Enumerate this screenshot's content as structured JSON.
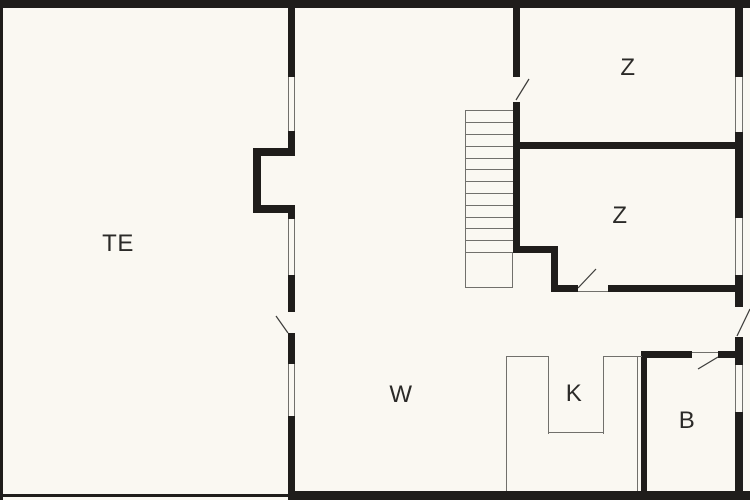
{
  "canvas": {
    "width": 750,
    "height": 500,
    "background": "#faf8f2",
    "wall_color": "#1f1d1b",
    "line_color": "#71706c",
    "swing_color": "#3a3a38",
    "label_color": "#2b2a28",
    "label_font_size": 24
  },
  "rooms": [
    {
      "id": "terrace",
      "label": "TE",
      "cx": 118,
      "cy": 244
    },
    {
      "id": "living-hall",
      "label": "W",
      "cx": 401,
      "cy": 395
    },
    {
      "id": "kitchen",
      "label": "K",
      "cx": 574,
      "cy": 394
    },
    {
      "id": "bathroom",
      "label": "B",
      "cx": 687,
      "cy": 421
    },
    {
      "id": "bedroom-top",
      "label": "Z",
      "cx": 628,
      "cy": 68
    },
    {
      "id": "bedroom-bottom",
      "label": "Z",
      "cx": 620,
      "cy": 216
    }
  ],
  "walls": [
    {
      "name": "wall-exterior-top",
      "x": 0,
      "y": 0,
      "w": 750,
      "h": 8
    },
    {
      "name": "wall-terrace-left-thin",
      "x": 0,
      "y": 0,
      "w": 3,
      "h": 500
    },
    {
      "name": "wall-terrace-bottom-thin",
      "x": 0,
      "y": 494,
      "w": 288,
      "h": 3
    },
    {
      "name": "wall-exterior-bottom",
      "x": 288,
      "y": 491,
      "w": 462,
      "h": 9
    },
    {
      "name": "wall-exterior-right-1",
      "x": 735,
      "y": 0,
      "w": 8,
      "h": 77
    },
    {
      "name": "wall-exterior-right-2",
      "x": 735,
      "y": 132,
      "w": 8,
      "h": 86
    },
    {
      "name": "wall-exterior-right-3",
      "x": 735,
      "y": 275,
      "w": 8,
      "h": 32
    },
    {
      "name": "wall-exterior-right-4",
      "x": 735,
      "y": 337,
      "w": 8,
      "h": 28
    },
    {
      "name": "wall-exterior-right-5",
      "x": 735,
      "y": 412,
      "w": 8,
      "h": 88
    },
    {
      "name": "wall-terrace-east-1",
      "x": 288,
      "y": 0,
      "w": 7,
      "h": 77
    },
    {
      "name": "wall-terrace-east-2",
      "x": 288,
      "y": 131,
      "w": 7,
      "h": 17
    },
    {
      "name": "wall-niche-top",
      "x": 253,
      "y": 148,
      "w": 42,
      "h": 8
    },
    {
      "name": "wall-niche-left",
      "x": 253,
      "y": 148,
      "w": 8,
      "h": 65
    },
    {
      "name": "wall-niche-bottom",
      "x": 253,
      "y": 205,
      "w": 42,
      "h": 8
    },
    {
      "name": "wall-terrace-east-3",
      "x": 288,
      "y": 213,
      "w": 7,
      "h": 6
    },
    {
      "name": "wall-terrace-east-4",
      "x": 288,
      "y": 275,
      "w": 7,
      "h": 37
    },
    {
      "name": "wall-terrace-east-5",
      "x": 288,
      "y": 333,
      "w": 7,
      "h": 31
    },
    {
      "name": "wall-terrace-east-6",
      "x": 288,
      "y": 416,
      "w": 7,
      "h": 84
    },
    {
      "name": "wall-stairhall-east-1",
      "x": 513,
      "y": 0,
      "w": 7,
      "h": 77
    },
    {
      "name": "wall-stairhall-east-2",
      "x": 513,
      "y": 102,
      "w": 7,
      "h": 151
    },
    {
      "name": "wall-stair-jog-horizontal",
      "x": 513,
      "y": 246,
      "w": 45,
      "h": 7
    },
    {
      "name": "wall-stair-jog-vertical",
      "x": 551,
      "y": 246,
      "w": 7,
      "h": 46
    },
    {
      "name": "wall-bedroom-divider",
      "x": 513,
      "y": 142,
      "w": 230,
      "h": 7
    },
    {
      "name": "wall-bedroom-bottom-south-1",
      "x": 551,
      "y": 285,
      "w": 27,
      "h": 7
    },
    {
      "name": "wall-bedroom-bottom-south-2",
      "x": 608,
      "y": 285,
      "w": 135,
      "h": 7
    },
    {
      "name": "wall-bathroom-top-1",
      "x": 641,
      "y": 351,
      "w": 51,
      "h": 7
    },
    {
      "name": "wall-bathroom-top-2",
      "x": 718,
      "y": 351,
      "w": 25,
      "h": 7
    },
    {
      "name": "wall-bathroom-west",
      "x": 641,
      "y": 351,
      "w": 6,
      "h": 149
    }
  ],
  "thin_lines": [
    {
      "name": "window-line",
      "x": 288,
      "y": 77,
      "w": 1.2,
      "h": 54
    },
    {
      "name": "window-line",
      "x": 293.8,
      "y": 77,
      "w": 1.2,
      "h": 54
    },
    {
      "name": "window-line",
      "x": 288,
      "y": 219,
      "w": 1.2,
      "h": 56
    },
    {
      "name": "window-line",
      "x": 293.8,
      "y": 219,
      "w": 1.2,
      "h": 56
    },
    {
      "name": "window-line",
      "x": 288,
      "y": 364,
      "w": 1.2,
      "h": 52
    },
    {
      "name": "window-line",
      "x": 293.8,
      "y": 364,
      "w": 1.2,
      "h": 52
    },
    {
      "name": "window-line",
      "x": 735,
      "y": 77,
      "w": 1.2,
      "h": 55
    },
    {
      "name": "window-line",
      "x": 741.8,
      "y": 77,
      "w": 1.2,
      "h": 55
    },
    {
      "name": "window-line",
      "x": 735,
      "y": 218,
      "w": 1.2,
      "h": 57
    },
    {
      "name": "window-line",
      "x": 741.8,
      "y": 218,
      "w": 1.2,
      "h": 57
    },
    {
      "name": "window-line",
      "x": 735,
      "y": 365,
      "w": 1.2,
      "h": 47
    },
    {
      "name": "window-line",
      "x": 741.8,
      "y": 365,
      "w": 1.2,
      "h": 47
    },
    {
      "name": "door-threshold",
      "x": 578,
      "y": 290.5,
      "w": 30,
      "h": 1.2
    },
    {
      "name": "door-threshold",
      "x": 692,
      "y": 352,
      "w": 26,
      "h": 1.2
    },
    {
      "name": "stair-edge-left",
      "x": 465,
      "y": 110,
      "w": 1.2,
      "h": 178
    },
    {
      "name": "stair-edge-top",
      "x": 465,
      "y": 110,
      "w": 48,
      "h": 1.2
    },
    {
      "name": "stair-edge-bottom",
      "x": 465,
      "y": 287,
      "w": 48,
      "h": 1.2
    },
    {
      "name": "stair-edge-right",
      "x": 511.8,
      "y": 253,
      "w": 1.2,
      "h": 35
    },
    {
      "name": "stair-tread",
      "x": 465,
      "y": 122,
      "w": 48,
      "h": 1.2
    },
    {
      "name": "stair-tread",
      "x": 465,
      "y": 134,
      "w": 48,
      "h": 1.2
    },
    {
      "name": "stair-tread",
      "x": 465,
      "y": 146,
      "w": 48,
      "h": 1.2
    },
    {
      "name": "stair-tread",
      "x": 465,
      "y": 158,
      "w": 48,
      "h": 1.2
    },
    {
      "name": "stair-tread",
      "x": 465,
      "y": 169,
      "w": 48,
      "h": 1.2
    },
    {
      "name": "stair-tread",
      "x": 465,
      "y": 181,
      "w": 48,
      "h": 1.2
    },
    {
      "name": "stair-tread",
      "x": 465,
      "y": 193,
      "w": 48,
      "h": 1.2
    },
    {
      "name": "stair-tread",
      "x": 465,
      "y": 205,
      "w": 48,
      "h": 1.2
    },
    {
      "name": "stair-tread",
      "x": 465,
      "y": 217,
      "w": 48,
      "h": 1.2
    },
    {
      "name": "stair-tread",
      "x": 465,
      "y": 228,
      "w": 48,
      "h": 1.2
    },
    {
      "name": "stair-tread",
      "x": 465,
      "y": 240,
      "w": 48,
      "h": 1.2
    },
    {
      "name": "stair-tread",
      "x": 465,
      "y": 252,
      "w": 48,
      "h": 1.2
    },
    {
      "name": "kitchen-counter-left",
      "x": 506,
      "y": 356,
      "w": 1.2,
      "h": 135
    },
    {
      "name": "kitchen-counter-right",
      "x": 637,
      "y": 356,
      "w": 1.2,
      "h": 135
    },
    {
      "name": "kitchen-counter-top-left",
      "x": 506,
      "y": 356,
      "w": 43,
      "h": 1.2
    },
    {
      "name": "kitchen-counter-top-right",
      "x": 603,
      "y": 356,
      "w": 39,
      "h": 1.2
    },
    {
      "name": "kitchen-notch-left",
      "x": 548,
      "y": 356,
      "w": 1.2,
      "h": 78
    },
    {
      "name": "kitchen-notch-right",
      "x": 603,
      "y": 356,
      "w": 1.2,
      "h": 78
    },
    {
      "name": "kitchen-notch-bottom",
      "x": 548,
      "y": 432,
      "w": 56,
      "h": 1.2
    }
  ],
  "door_swings": [
    {
      "name": "door-swing-bedroom-top",
      "x1": 516,
      "y1": 100,
      "x2": 529,
      "y2": 79
    },
    {
      "name": "door-swing-terrace",
      "x1": 276,
      "y1": 316,
      "x2": 288,
      "y2": 333
    },
    {
      "name": "door-swing-bedroom-bottom",
      "x1": 578,
      "y1": 288,
      "x2": 596,
      "y2": 269
    },
    {
      "name": "door-swing-bathroom",
      "x1": 718,
      "y1": 357,
      "x2": 698,
      "y2": 369
    },
    {
      "name": "door-swing-entrance",
      "x1": 737,
      "y1": 336,
      "x2": 750,
      "y2": 309
    }
  ]
}
